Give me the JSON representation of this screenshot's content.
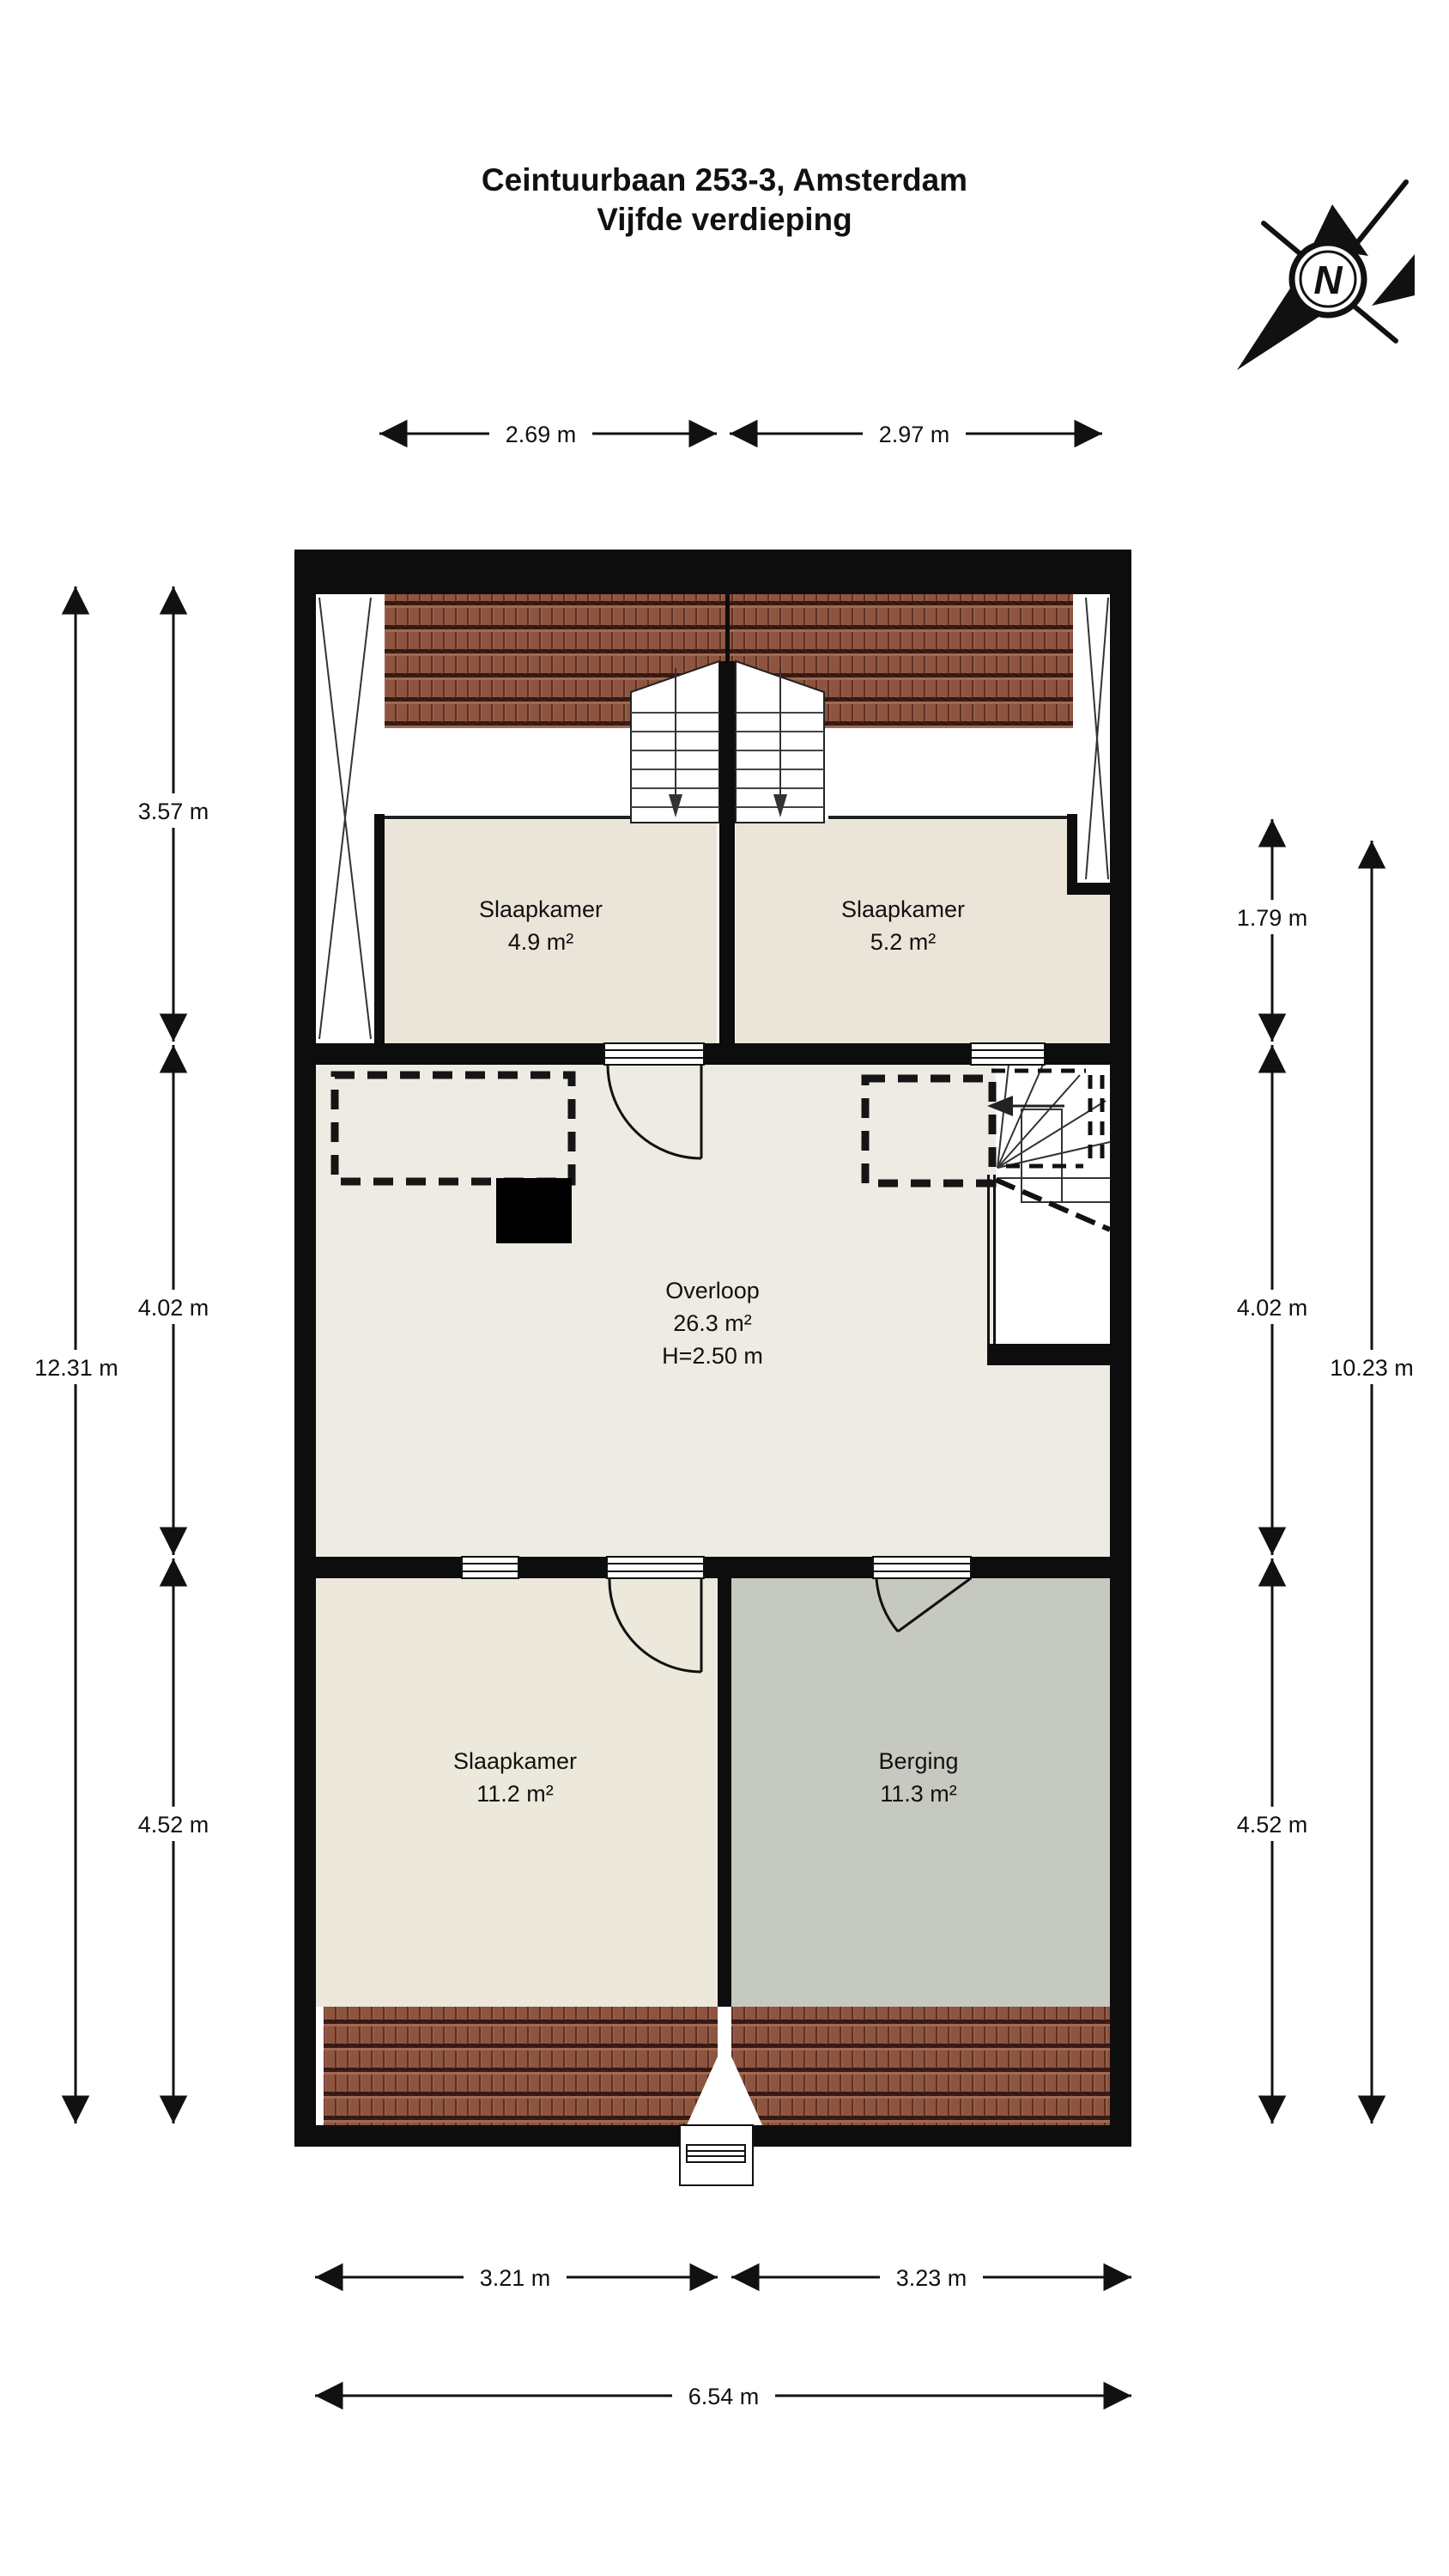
{
  "title": {
    "line1": "Ceintuurbaan 253-3, Amsterdam",
    "line2": "Vijfde verdieping"
  },
  "compass": {
    "north_label": "N"
  },
  "rooms": [
    {
      "name": "Slaapkamer",
      "area": "4.9 m²"
    },
    {
      "name": "Slaapkamer",
      "area": "5.2 m²"
    },
    {
      "name": "Overloop",
      "area": "26.3 m²",
      "height": "H=2.50 m"
    },
    {
      "name": "Slaapkamer",
      "area": "11.2 m²"
    },
    {
      "name": "Berging",
      "area": "11.3 m²"
    }
  ],
  "dimensions": {
    "top": [
      "2.69 m",
      "2.97 m"
    ],
    "left_inner": [
      "3.57 m",
      "4.02 m",
      "4.52 m"
    ],
    "left_total": "12.31 m",
    "right_inner": [
      "1.79 m",
      "4.02 m",
      "4.52 m"
    ],
    "right_total": "10.23 m",
    "bottom": [
      "3.21 m",
      "3.23 m"
    ],
    "bottom_total": "6.54 m"
  },
  "colors": {
    "wall": "#0d0d0d",
    "roof_tile": "#8d5440",
    "roof_tile_dark": "#3c1e16",
    "bedroom_floor": "#eae5d8",
    "hall_floor": "#edebe3",
    "storage_floor": "#c6c9c0",
    "page_bg": "#ffffff"
  }
}
